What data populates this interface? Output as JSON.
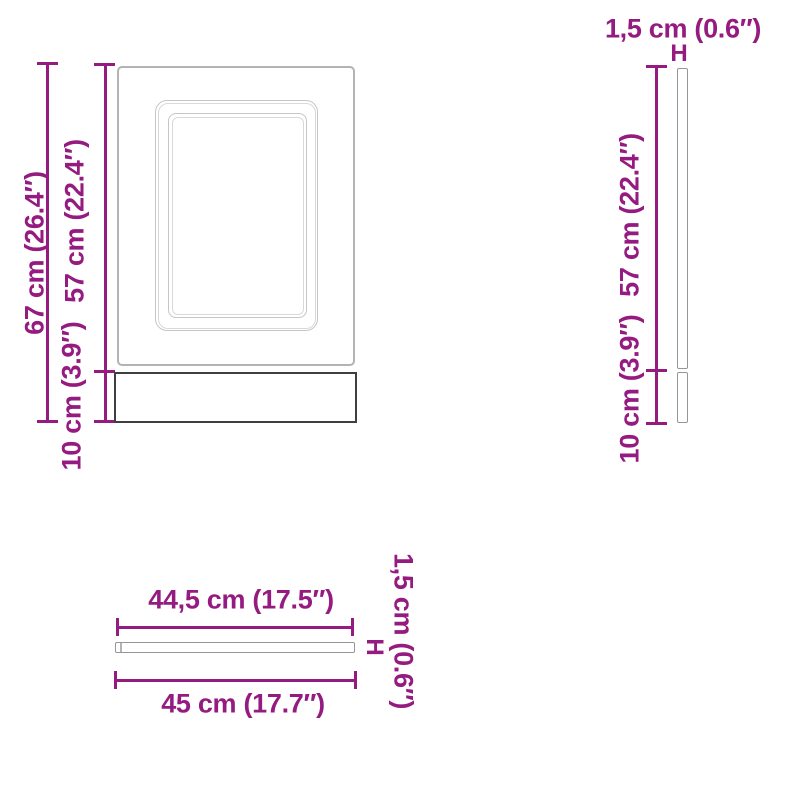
{
  "diagram": {
    "type": "product-dimension-diagram",
    "colors": {
      "accent": "#951b81",
      "door-outline": "#b3b3b3",
      "frame-outline": "#c6c6c6",
      "frame-outline-light": "#d9d9d9",
      "panel-outline": "#969696",
      "plinth-outline": "#3f3f3f"
    },
    "views": {
      "front": {
        "total_height_label": "67 cm (26.4″)",
        "door_height_label": "57 cm (22.4″)",
        "plinth_height_label": "10 cm (3.9″)"
      },
      "side": {
        "thickness_label": "1,5 cm (0.6″)",
        "thickness_marker": "H",
        "door_height_label": "57 cm (22.4″)",
        "plinth_height_label": "10 cm (3.9″)"
      },
      "top": {
        "inner_width_label": "44,5 cm (17.5″)",
        "outer_width_label": "45 cm (17.7″)",
        "thickness_label": "1,5 cm (0.6″)",
        "thickness_marker": "H"
      }
    }
  }
}
